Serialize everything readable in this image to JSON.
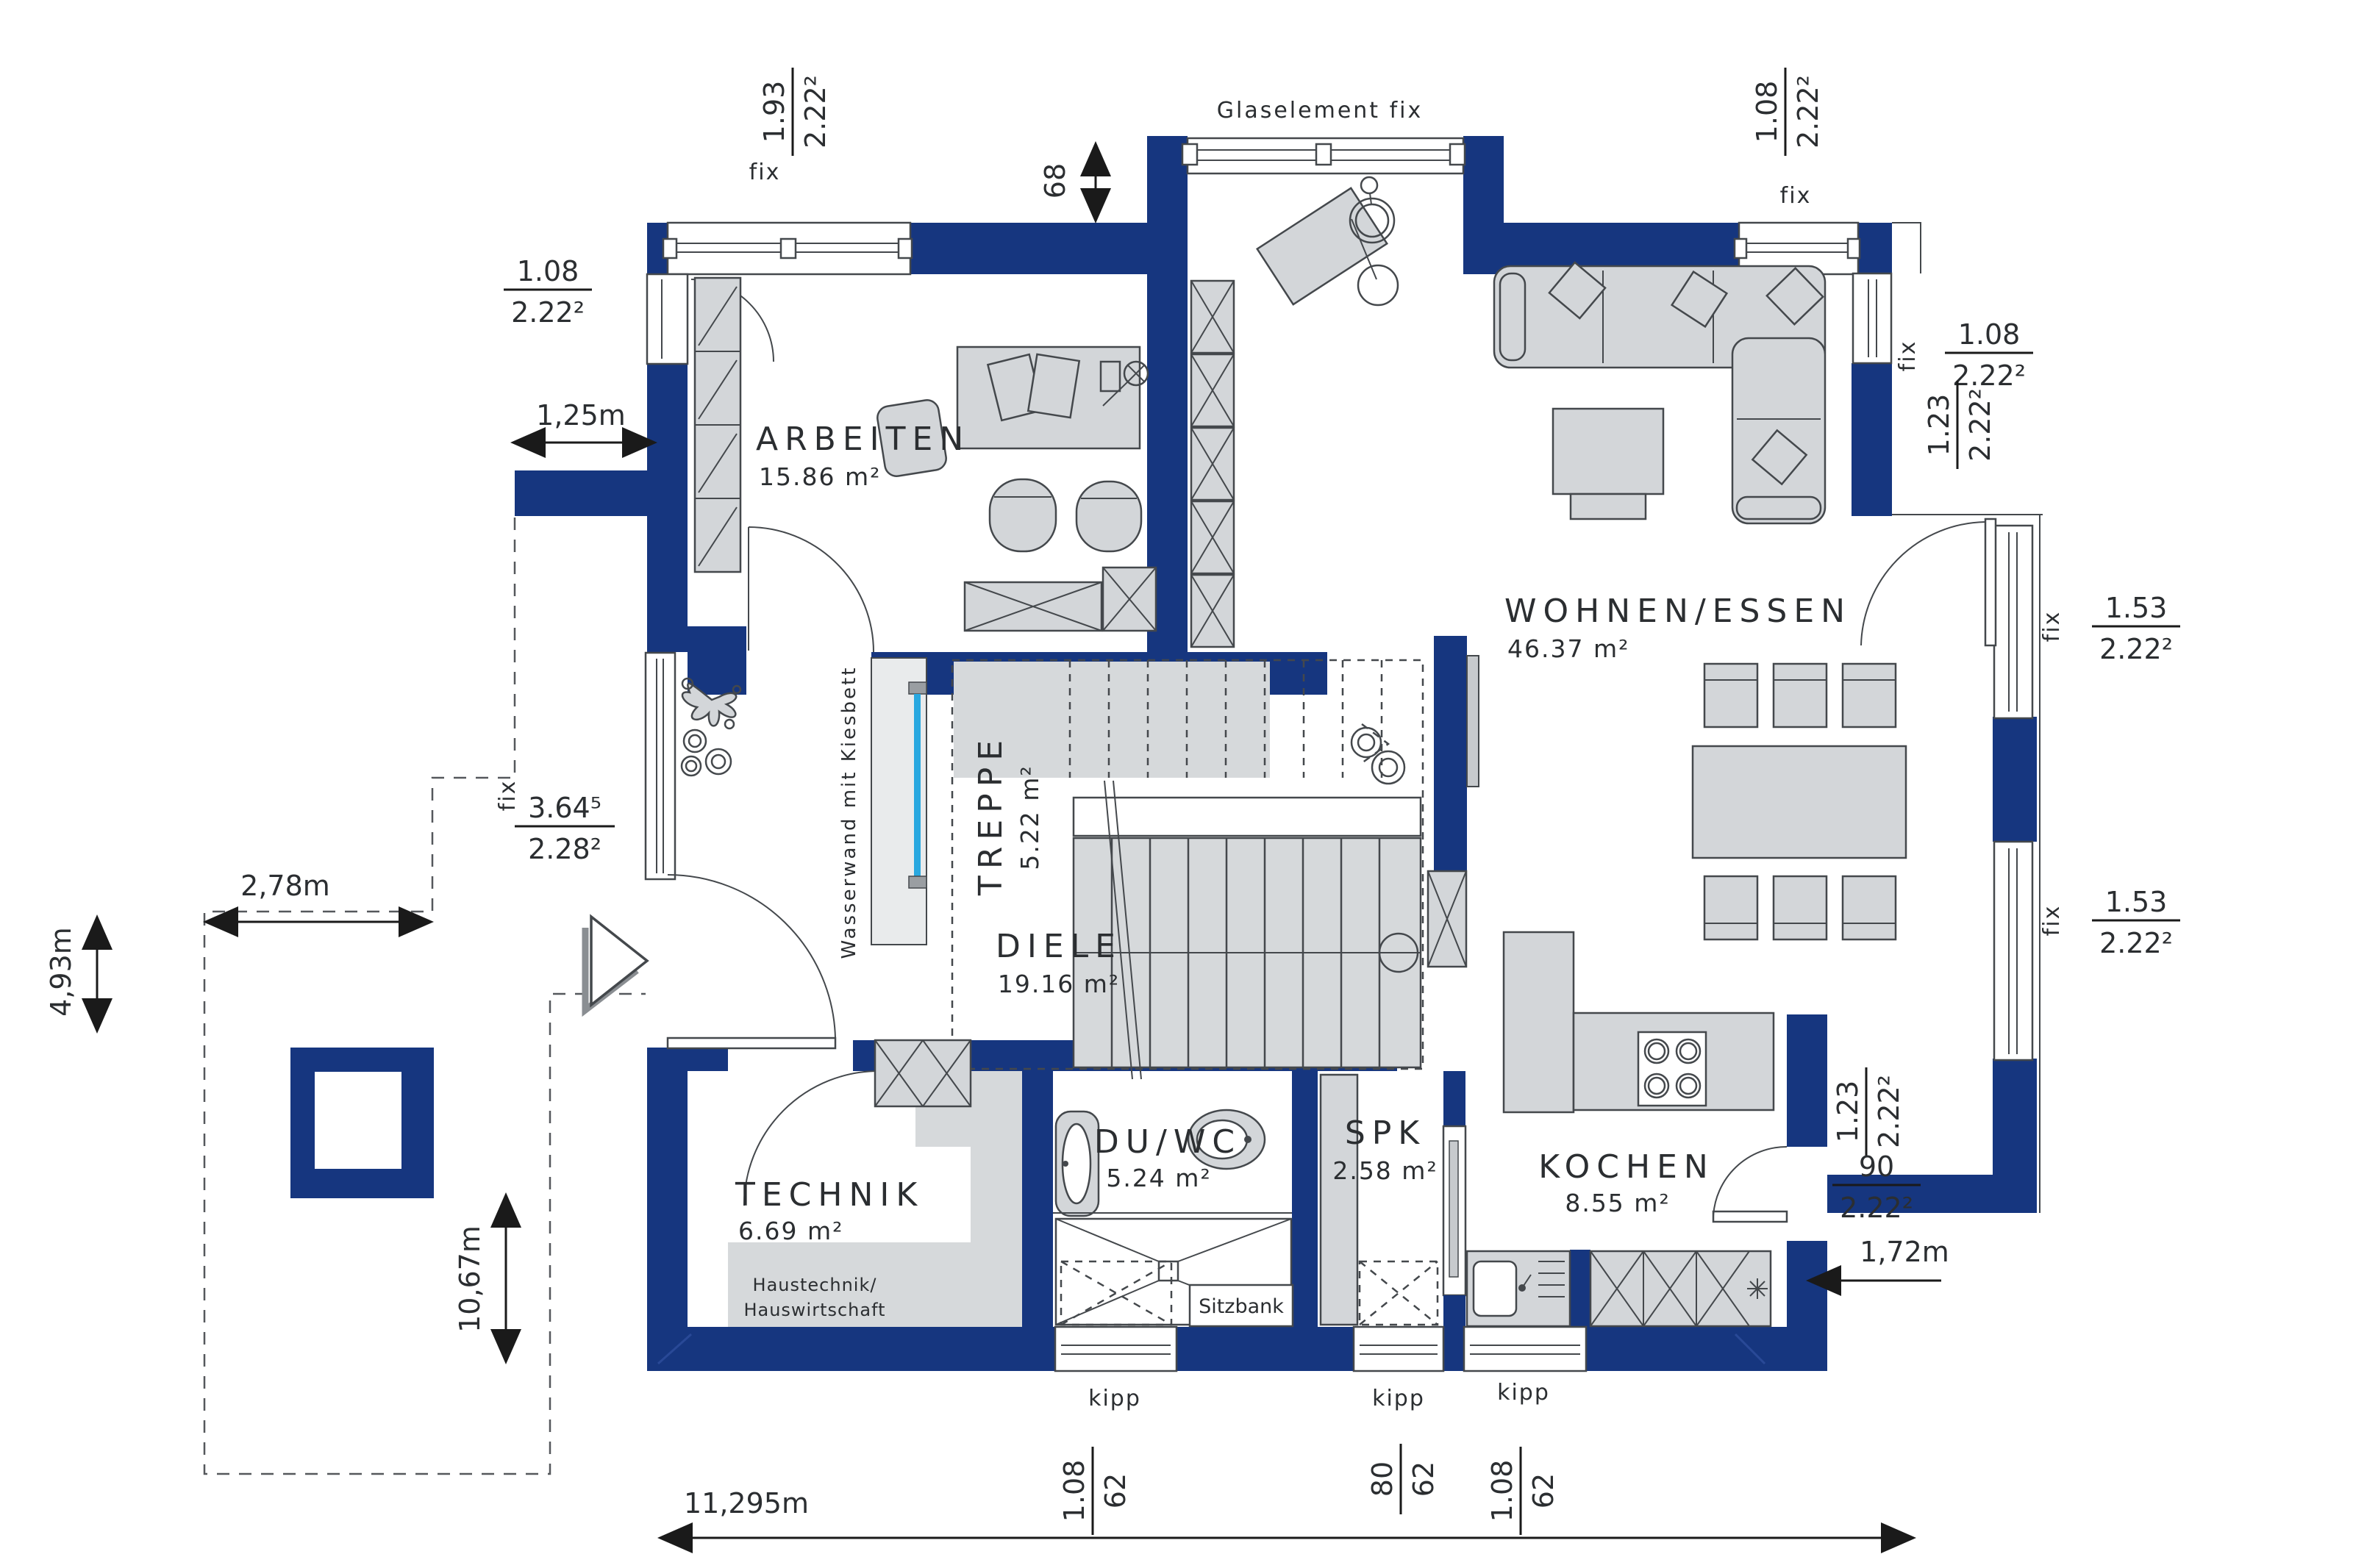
{
  "colors": {
    "wall_blue": "#16367f",
    "furniture_gray": "#d3d6d9",
    "floor_gray": "#d6d9db",
    "water_blue": "#29a8e0",
    "line_dark": "#44484c",
    "text_dark": "#2b2e31",
    "background": "#ffffff"
  },
  "rooms": {
    "arbeiten": {
      "name": "ARBEITEN",
      "area": "15.86 m²"
    },
    "wohnen": {
      "name": "WOHNEN/ESSEN",
      "area": "46.37 m²"
    },
    "treppe": {
      "name": "TREPPE",
      "area": "5.22 m²"
    },
    "diele": {
      "name": "DIELE",
      "area": "19.16 m²"
    },
    "technik": {
      "name": "TECHNIK",
      "area": "6.69 m²",
      "note1": "Haustechnik/",
      "note2": "Hauswirtschaft"
    },
    "duwc": {
      "name": "DU/WC",
      "area": "5.24 m²"
    },
    "spk": {
      "name": "SPK",
      "area": "2.58 m²"
    },
    "kochen": {
      "name": "KOCHEN",
      "area": "8.55 m²"
    }
  },
  "annotations": {
    "glaselement": "Glaselement fix",
    "wasserwand": "Wasserwand mit Kiesbett",
    "sitzbank": "Sitzbank",
    "fix": "fix",
    "kipp": "kipp"
  },
  "fractions": [
    {
      "num": "1.93",
      "den": "2.22²"
    },
    {
      "num": "1.08",
      "den": "2.22²"
    },
    {
      "num": "1.08",
      "den": "2.22²"
    },
    {
      "num": "1.08",
      "den": "2.22²"
    },
    {
      "num": "1.23",
      "den": "2.22²"
    },
    {
      "num": "1.53",
      "den": "2.22²"
    },
    {
      "num": "1.53",
      "den": "2.22²"
    },
    {
      "num": "3.64⁵",
      "den": "2.28²"
    },
    {
      "num": "1.23",
      "den": "2.22²"
    },
    {
      "num": "90",
      "den": "2.22²"
    },
    {
      "num": "1.08",
      "den": "62"
    },
    {
      "num": "80",
      "den": "62"
    },
    {
      "num": "1.08",
      "den": "62"
    }
  ],
  "linears": {
    "d68": "68",
    "d125": "1,25m",
    "d278": "2,78m",
    "d493": "4,93m",
    "d1067": "10,67m",
    "d172": "1,72m",
    "d11295": "11,295m"
  }
}
